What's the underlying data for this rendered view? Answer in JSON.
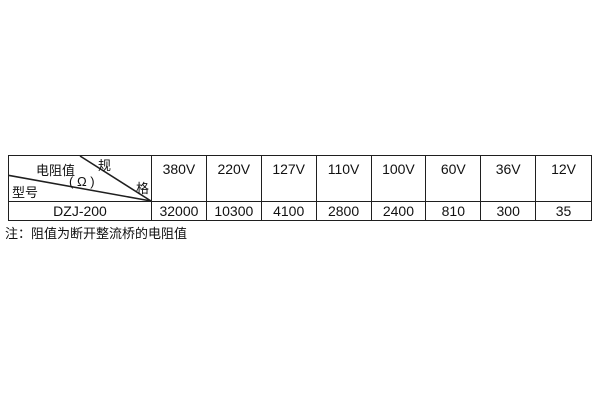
{
  "table": {
    "corner": {
      "spec_top": "规",
      "spec_bottom": "格",
      "resistance_label": "电阻值",
      "resistance_unit": "( Ω )",
      "model_label": "型号"
    },
    "columns": [
      "380V",
      "220V",
      "127V",
      "110V",
      "100V",
      "60V",
      "36V",
      "12V"
    ],
    "rows": [
      {
        "model": "DZJ-200",
        "values": [
          "32000",
          "10300",
          "4100",
          "2800",
          "2400",
          "810",
          "300",
          "35"
        ]
      }
    ]
  },
  "note": "注：阻值为断开整流桥的电阻值",
  "colors": {
    "border": "#1f1f1f",
    "text": "#111111",
    "background": "#ffffff"
  }
}
